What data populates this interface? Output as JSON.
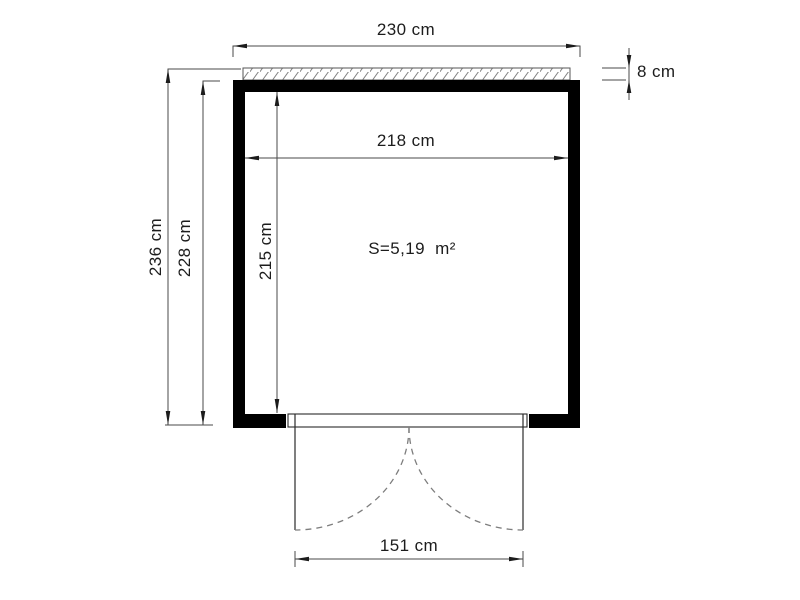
{
  "figure": {
    "type": "floor-plan",
    "area_label": "S=5,19  m²",
    "dimensions": {
      "outer_width": "230 cm",
      "roof_strip_thickness": "8 cm",
      "inner_width": "218 cm",
      "total_depth": "236 cm",
      "wall_depth": "228 cm",
      "inner_depth": "215 cm",
      "door_width": "151 cm"
    },
    "colors": {
      "background": "#ffffff",
      "wall": "#000000",
      "line": "#4a4a4a",
      "text": "#1c1c1c",
      "door_swing": "#7d7d7d"
    }
  }
}
